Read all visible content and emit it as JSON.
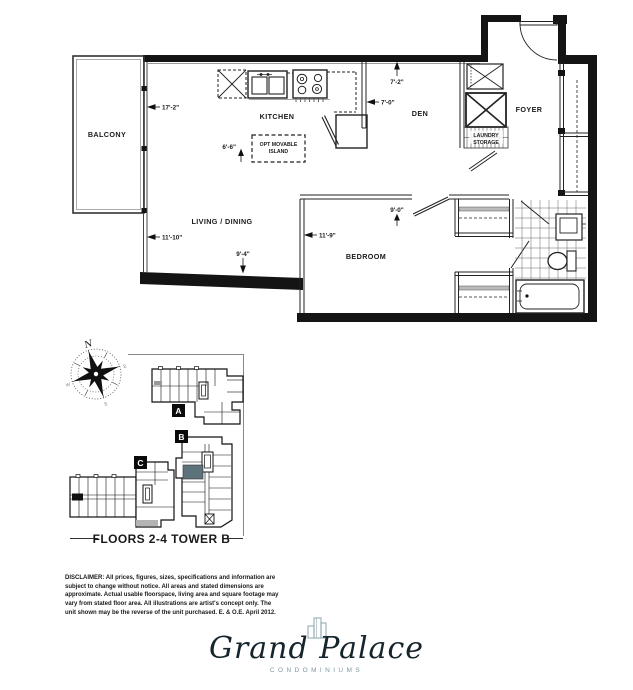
{
  "plan": {
    "rooms": {
      "balcony": "BALCONY",
      "kitchen": "KITCHEN",
      "den": "DEN",
      "foyer": "FOYER",
      "living_dining": "LIVING / DINING",
      "bedroom": "BEDROOM",
      "island_line1": "OPT MOVABLE",
      "island_line2": "ISLAND",
      "laundry_line1": "LAUNDRY",
      "laundry_line2": "STORAGE"
    },
    "dimensions": {
      "balcony_wall": "17'-2\"",
      "living_wall": "11'-10\"",
      "living_width": "9'-4\"",
      "island_width": "6'-6\"",
      "den_top": "7'-2\"",
      "den_side": "7'-0\"",
      "bedroom_side": "11'-9\"",
      "bedroom_width": "9'-0\""
    }
  },
  "keyplan": {
    "caption": "FLOORS 2-4 TOWER B",
    "tower_a_label": "A",
    "tower_b_label": "B",
    "tower_c_label": "C",
    "highlight_color": "#5e727c",
    "compass": {
      "north": "N",
      "west": "W",
      "south": "S",
      "east": "E"
    }
  },
  "disclaimer": {
    "text": "DISCLAIMER: All prices, figures, sizes, specifications and information are subject to change without notice. All areas and stated dimensions are approximate. Actual usable floorspace, living area and square footage may vary from stated floor area. All illustrations are artist's concept only. The unit shown may be the reverse of the unit purchased. E. & O.E. April 2012."
  },
  "logo": {
    "name": "Grand Palace",
    "tagline": "CONDOMINIUMS"
  }
}
